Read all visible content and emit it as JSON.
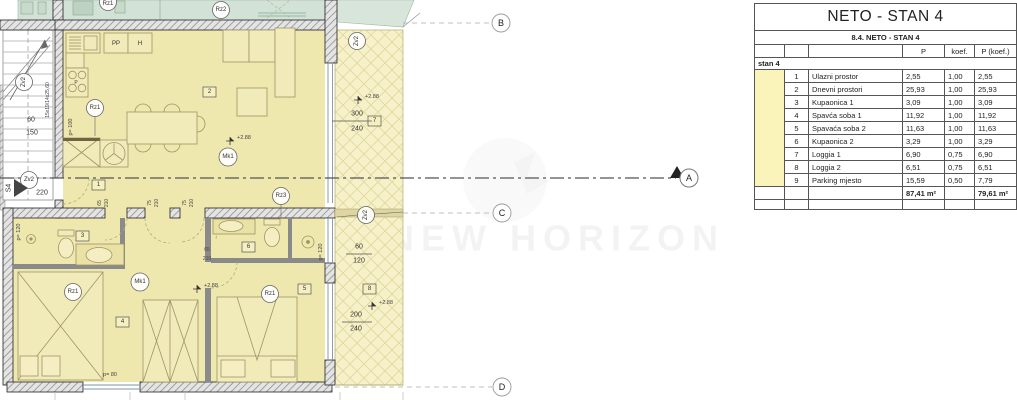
{
  "plan": {
    "labels": {
      "rz1": "Rz1",
      "rz2": "Rz2",
      "rz3": "Rz3",
      "mk1": "Mk1",
      "zv2": "Zv2",
      "pp": "PP",
      "h": "H",
      "p": "P",
      "room1": "1",
      "room2": "2",
      "room3": "3",
      "room4": "4",
      "room5": "5",
      "room6": "6",
      "room7": "7",
      "room8": "8",
      "elev": "+2.88",
      "stair_steps": "15x19/14x25,60",
      "s4": "S4",
      "dim60": "60",
      "dim150": "150",
      "dim220": "220",
      "dim300": "300",
      "dim240": "240",
      "dim200": "200",
      "dim120": "120",
      "door65": "65",
      "door75": "75",
      "door210": "210",
      "p100": "p= 100",
      "p120": "p= 120",
      "p80": "p= 80",
      "secA": "A",
      "secB": "B",
      "secC": "C",
      "secD": "D"
    },
    "colors": {
      "floor": "#eee7ae",
      "loggia": "#f7f1c9",
      "green": "#d3e2d6",
      "wall": "#8a8a8a"
    }
  },
  "watermark": "NEW HORIZON",
  "table": {
    "title": "NETO - STAN 4",
    "subtitle": "8.4. NETO - STAN 4",
    "col_p": "P",
    "col_koef": "koef.",
    "col_pkoef": "P (koef.)",
    "group": "stan 4",
    "rows": [
      {
        "num": "1",
        "name": "Ulazni prostor",
        "p": "2,55",
        "koef": "1,00",
        "pk": "2,55"
      },
      {
        "num": "2",
        "name": "Dnevni prostori",
        "p": "25,93",
        "koef": "1,00",
        "pk": "25,93"
      },
      {
        "num": "3",
        "name": "Kupaonica 1",
        "p": "3,09",
        "koef": "1,00",
        "pk": "3,09"
      },
      {
        "num": "4",
        "name": "Spavća soba 1",
        "p": "11,92",
        "koef": "1,00",
        "pk": "11,92"
      },
      {
        "num": "5",
        "name": "Spavaća soba 2",
        "p": "11,63",
        "koef": "1,00",
        "pk": "11,63"
      },
      {
        "num": "6",
        "name": "Kupaonica 2",
        "p": "3,29",
        "koef": "1,00",
        "pk": "3,29"
      },
      {
        "num": "7",
        "name": "Loggia 1",
        "p": "6,90",
        "koef": "0,75",
        "pk": "6,90"
      },
      {
        "num": "8",
        "name": "Loggia 2",
        "p": "6,51",
        "koef": "0,75",
        "pk": "6,51"
      },
      {
        "num": "9",
        "name": "Parking mjesto",
        "p": "15,59",
        "koef": "0,50",
        "pk": "7,79"
      }
    ],
    "total_p": "87,41 m²",
    "total_pk": "79,61 m²"
  }
}
